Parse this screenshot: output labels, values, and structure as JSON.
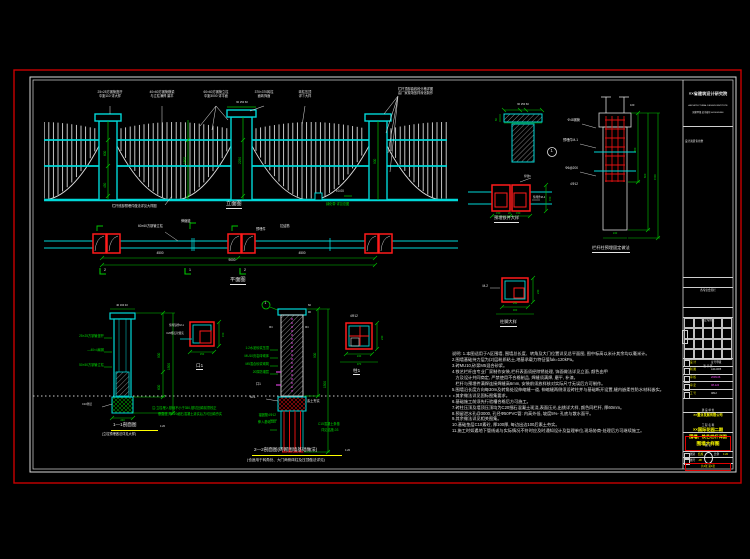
{
  "elevation": {
    "title": "立面图",
    "top_labels": [
      "25×25方钢管竖杆\n中距110 详大样",
      "40×60方钢管横梁\n与立柱满焊 磨平",
      "60×60方钢管立柱\n中距3000 详平面",
      "370×370砖柱\n面砖饰面",
      "砖柱压顶\n详①大样",
      "栏杆顶部曲线段分格详图\n由厂家现场放样深化制作"
    ],
    "cap_dim": "60 250 60",
    "dims": {
      "post1_upper": "600",
      "post1_lower": "450",
      "mid": "1800",
      "post2": "2250",
      "post3": "900"
    },
    "level": "±0.00",
    "green_note": "绿化带 详见总图",
    "bottom_note": "栏杆底部预埋件做法详见大样图"
  },
  "plan": {
    "title": "平面图",
    "labels": {
      "post": "60×60方钢管立柱",
      "joint": "伸缩缝",
      "embed": "预埋件",
      "tie": "拉结筋"
    },
    "dims": [
      "4500",
      "4500",
      "9000"
    ],
    "marks": [
      "2",
      "1",
      "2"
    ]
  },
  "cap_detail": {
    "callout": "1",
    "dim_top": "60 250 60",
    "dim_side": "60"
  },
  "embed_detail": {
    "title": "预埋铁件大样",
    "labels": {
      "weld": "焊缝6",
      "plate": "预埋件M-1"
    },
    "dims": {
      "side": "150",
      "b1": "150",
      "b2": "20",
      "b3": "150"
    }
  },
  "column_detail": {
    "title": "栏杆柱预埋固定做法",
    "labels": [
      "Φ48钢管",
      "预埋件M-1",
      "Φ6@200",
      "4Φ12"
    ],
    "dims": {
      "top": "100",
      "d1": "450",
      "d2": "600",
      "d3": "1500",
      "bottom": "240"
    }
  },
  "base_detail": {
    "title": "柱脚大样",
    "label": "M-2",
    "dims": {
      "b": "240",
      "r": "240",
      "b2": "300"
    }
  },
  "section11": {
    "title": "1—1剖面图",
    "scale": "1:20",
    "subtitle": "(立柱预埋做法详见大样)",
    "labels": [
      "25×25方钢管竖杆",
      "—40×4扁钢",
      "50×50方钢管立柱"
    ],
    "pad_label": "C10垫层",
    "note1": "注:立柱埋入基础不小于350,基坑回填前须校正",
    "note2": "垂直度,用C20细石混凝土灌实后方可回填夯实",
    "dims": {
      "top": "40 160 40",
      "d1": "900",
      "d2": "600",
      "d3": "1500",
      "bottom": "240"
    }
  },
  "box1_detail": {
    "title": "口1",
    "labels": [
      "预埋铁件M-1",
      "C20细石砼灌实"
    ],
    "dims": {
      "r": "150",
      "b": "150"
    }
  },
  "section22": {
    "title": "2—2剖面图(砖砌围墙基础做法)",
    "scale": "1:20",
    "subtitle": "(也适用于转角处、大门两侧砖柱及压顶做法详见)",
    "callout": "1",
    "side_mark": "Φ4",
    "labels": [
      "1:2水泥砂浆压顶",
      "MU10页岩砖砌体",
      "M5混合砂浆砌筑",
      "20厚防潮层"
    ],
    "box_ref": "口1",
    "plate_ref": "M-1",
    "soil": "素土夯实",
    "anchor1": "锚固筋4Φ12",
    "anchor2": "伸入基础350",
    "footing1": "C15混凝土条基",
    "footing2": "详见结施-03",
    "dims": {
      "t1": "60",
      "t2": "90",
      "d1": "900",
      "d2": "1500"
    }
  },
  "col1_detail": {
    "title": "柱1",
    "label": "4Φ12",
    "dims": {
      "b": "240",
      "r": "240",
      "b2": "370"
    }
  },
  "notes": {
    "lines": [
      "说明: 1.本图适用于A区围墙, 围墙总长度、转角及大门位置详见总平面图, 图中标高以米计其余均以毫米计。",
      "2.围墙基础持力层为(2)层粉质粘土,地基承载力特征值fak=120kPa。",
      "3.砖MU10,砂浆M5混合砂浆。",
      "4.铁艺栏杆由专业厂家制作安装,栏杆表面须经除锈处理, 饰面做法详见立面, 颜色由甲",
      "   方及设计共同商定, 严禁使用不合格制品, 焊缝须满焊, 磨平, 补漆。",
      "   栏杆与预埋件满焊连接焊缝高6mm, 安装前须放样核对实际尺寸无误后方可制作。",
      "5.围墙沿长度方向每30m及转角处设伸缩缝一道, 伸缩缝两侧须设砖柱并与基础断开设置,缝内嵌柔性防水材料嵌实。",
      "   其余做法详见国标图集要求。",
      "6.基础施工前须先行验槽合格后方可施工。",
      "7.砖柱压顶及墙顶压顶均为C20细石混凝土现浇,表面压光,出挑详大样, 颜色同栏杆, 厚60mm。",
      "8.预留泄水孔@3000, 孔径Φ50PVC管: 内高外低, 坡度5%- 孔底与散水面平。",
      "9.其余做法详见相关图集。",
      "10.基础垫层C10素砼, 厚100厚, 每边出边100后素土夯实。",
      "11.施工时如遇地下管线或与实际情况不符时应及时通知设计及监理单位,现场协商-处理后方可继续施工。"
    ]
  },
  "titleblock": {
    "org": {
      "l1": "××省建筑设计研究院",
      "l2": "ARCHITECTURAL DESIGN INSTITUTE",
      "l3": "国家甲级 证书编号 A114005566",
      "sub": "设计资质专用章"
    },
    "row1": "各专业会签栏",
    "row2": "审定专用栏",
    "sign_header": "签 字 区",
    "rows": [
      {
        "k": "设 计",
        "v": "证号甲级"
      },
      {
        "k": "制 图",
        "v": "A114005"
      },
      {
        "k": "审 核",
        "v": "2009.06"
      },
      {
        "k": "审 定",
        "v": "08-124"
      },
      {
        "k": "工 号",
        "v": "0812"
      }
    ],
    "owner_label": "建 设 单 位",
    "owner": "××置业发展有限公司",
    "project_label": "工 程 名 称",
    "project1": "××国际花园二期",
    "project2": "围墙、铁艺栏杆详图",
    "dwg_label": "图 名",
    "dwg_title": "围墙大样图",
    "meta": {
      "type_label": "图别",
      "type": "结施",
      "no_label": "图号",
      "no": "-08",
      "scale_label": "比例",
      "scale": "1:20"
    },
    "sheet_info": "共2张 第1张"
  }
}
